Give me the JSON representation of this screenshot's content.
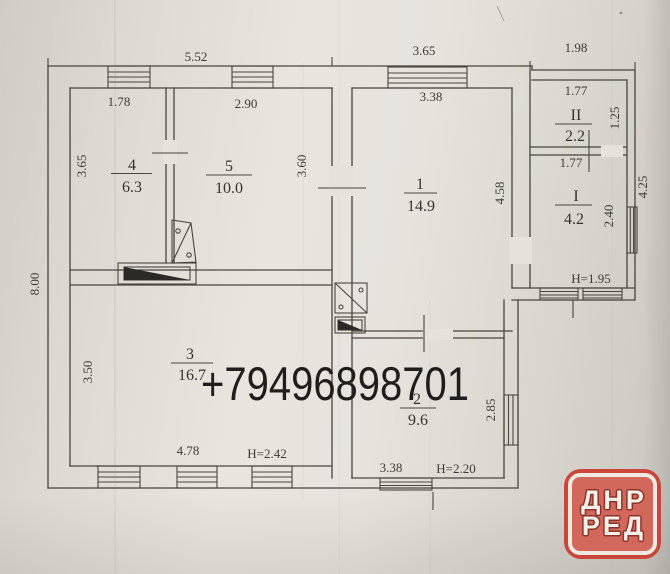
{
  "watermark": {
    "phone": "+79496898701"
  },
  "logo": {
    "line1": "ДНР",
    "line2": "РЕД"
  },
  "colors": {
    "paper": "#e6e3dd",
    "ink": "#4a453e",
    "logo_ring": "#c8473a",
    "logo_bg": "#d2685b",
    "logo_text": "#f4efe8",
    "phone_text": "#1f1e1c"
  },
  "dims": {
    "top_1": "5.52",
    "top_2": "3.65",
    "top_3": "1.98",
    "left": "8.00",
    "room4_top": "1.78",
    "room5_top": "2.90",
    "room4_left": "3.65",
    "room5_right": "3.60",
    "room1_top": "3.38",
    "room1_right": "4.58",
    "room3_left": "3.50",
    "room3_bottom": "4.78",
    "room3_height": "H=2.42",
    "room2_bottom": "3.38",
    "room2_height": "H=2.20",
    "room2_right": "2.85",
    "roomII_top": "1.77",
    "roomII_right": "1.25",
    "roomI_top": "1.77",
    "roomI_right": "2.40",
    "annex_right": "4.25",
    "annex_height": "H=1.95"
  },
  "rooms": {
    "r1": {
      "number": "1",
      "area": "14.9"
    },
    "r2": {
      "number": "2",
      "area": "9.6"
    },
    "r3": {
      "number": "3",
      "area": "16.7"
    },
    "r4": {
      "number": "4",
      "area": "6.3"
    },
    "r5": {
      "number": "5",
      "area": "10.0"
    },
    "rI": {
      "number": "I",
      "area": "4.2"
    },
    "rII": {
      "number": "II",
      "area": "2.2"
    }
  }
}
